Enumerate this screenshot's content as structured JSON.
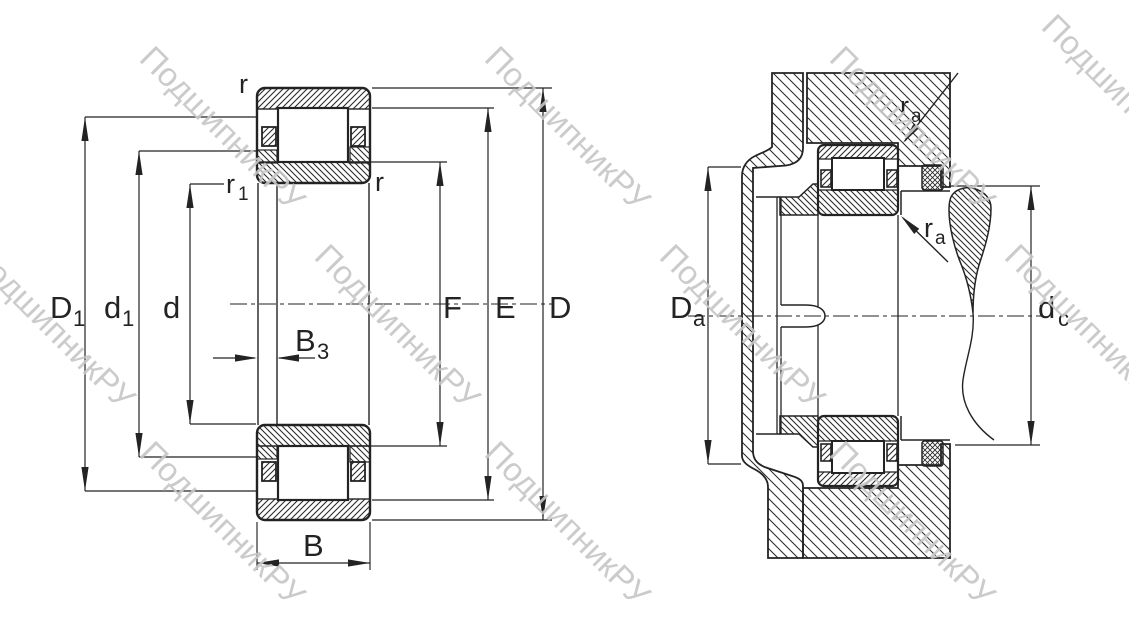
{
  "title": "Bearing dimension drawing",
  "watermark": {
    "text": "ПодшипникРУ",
    "color": "#c6c6c6"
  },
  "colors": {
    "line": "#232323",
    "background": "#ffffff"
  },
  "left_view": {
    "name": "bearing-cross-section",
    "labels": {
      "r_top": {
        "main": "r",
        "sub": ""
      },
      "r1": {
        "main": "r",
        "sub": "1"
      },
      "r_inner": {
        "main": "r",
        "sub": ""
      },
      "D1": {
        "main": "D",
        "sub": "1"
      },
      "d1": {
        "main": "d",
        "sub": "1"
      },
      "d": {
        "main": "d",
        "sub": ""
      },
      "B3": {
        "main": "B",
        "sub": "3"
      },
      "B": {
        "main": "B",
        "sub": ""
      },
      "F": {
        "main": "F",
        "sub": ""
      },
      "E": {
        "main": "E",
        "sub": ""
      },
      "D": {
        "main": "D",
        "sub": ""
      }
    }
  },
  "right_view": {
    "name": "mounted-bearing-arrangement",
    "labels": {
      "ra_top": {
        "main": "r",
        "sub": "a"
      },
      "ra_bottom": {
        "main": "r",
        "sub": "a"
      },
      "Da": {
        "main": "D",
        "sub": "a"
      },
      "dc": {
        "main": "d",
        "sub": "c"
      }
    }
  }
}
